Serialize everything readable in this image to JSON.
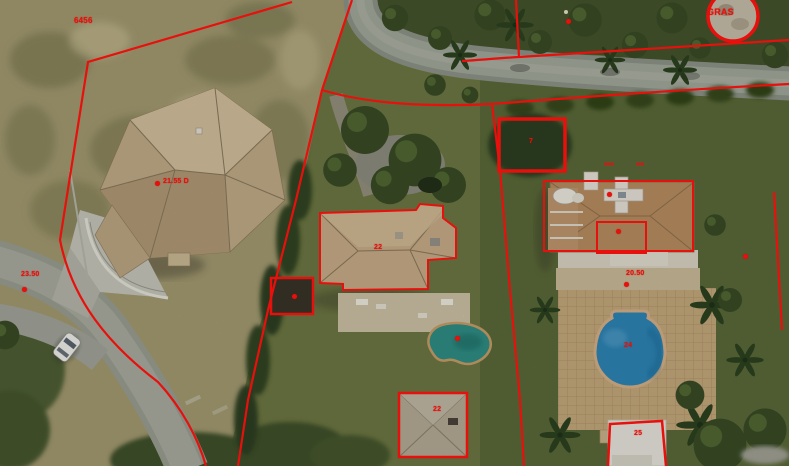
{
  "colors": {
    "overlay_red": "#e8100c",
    "pool_center": "#2f8f86",
    "pool_right": "#2e86b8",
    "roof_left_villa": "#c4ad89",
    "roof_center_villa": "#c9ae8a",
    "roof_right_villa": "#b98e62",
    "road": "#9ba096",
    "sand": "#a59c72",
    "lawn": "#66713f"
  },
  "annotations": {
    "labels": [
      {
        "id": "plot-number-topleft",
        "text": "6456",
        "x": 74,
        "y": 17,
        "size": 8
      },
      {
        "id": "elevation-left-villa",
        "text": "21.55 D",
        "x": 163,
        "y": 178,
        "size": 7
      },
      {
        "id": "elevation-road-left",
        "text": "23.50",
        "x": 21,
        "y": 271,
        "size": 7
      },
      {
        "id": "elevation-right-villa",
        "text": "20.50",
        "x": 626,
        "y": 270,
        "size": 7
      },
      {
        "id": "label-gras",
        "text": "GRAS",
        "x": 707,
        "y": 8,
        "size": 9
      },
      {
        "id": "mark-center-villa",
        "text": "22",
        "x": 374,
        "y": 244,
        "size": 7
      },
      {
        "id": "mark-outbuilding",
        "text": "22",
        "x": 433,
        "y": 406,
        "size": 7
      },
      {
        "id": "mark-bottom-structure",
        "text": "25",
        "x": 634,
        "y": 430,
        "size": 7
      },
      {
        "id": "mark-right-square",
        "text": "7",
        "x": 529,
        "y": 138,
        "size": 7
      },
      {
        "id": "mark-right-pool",
        "text": "24",
        "x": 624,
        "y": 342,
        "size": 7
      }
    ],
    "dots": [
      {
        "id": "dot-left-villa",
        "x": 157,
        "y": 183
      },
      {
        "id": "dot-road-left",
        "x": 24,
        "y": 289
      },
      {
        "id": "dot-right-villa",
        "x": 626,
        "y": 284
      },
      {
        "id": "dot-small-square",
        "x": 294,
        "y": 296
      },
      {
        "id": "dot-center-pool",
        "x": 457,
        "y": 338
      },
      {
        "id": "dot-top-boundary",
        "x": 568,
        "y": 21
      },
      {
        "id": "dot-right-garden",
        "x": 745,
        "y": 256
      },
      {
        "id": "dot-right-villa-roof",
        "x": 609,
        "y": 194
      },
      {
        "id": "dot-right-villa-inner",
        "x": 618,
        "y": 231
      }
    ]
  }
}
